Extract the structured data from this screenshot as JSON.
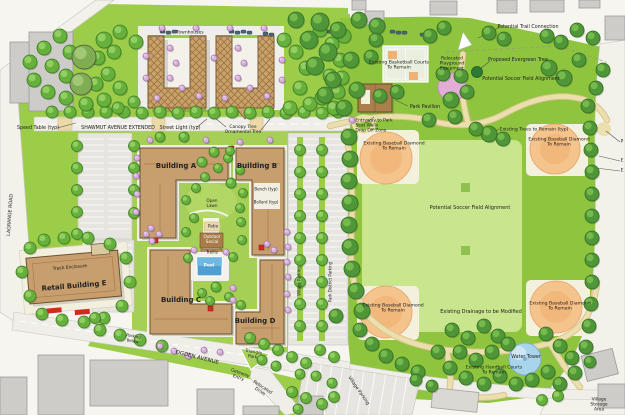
{
  "plan": {
    "type": "Illustrative Site Master Plan",
    "colors": {
      "lawn_green": "#9ccd49",
      "park_green": "#8ec43e",
      "soccer_field_green": "#c9e58e",
      "courtyard_green": "#a5d055",
      "building_tan": "#c79e6d",
      "building_outline": "#6e5130",
      "existing_gray_building": "#cdccc8",
      "road_gray": "#efeee8",
      "parking_gray": "#e6e5df",
      "path_tan": "#ecdfae",
      "baseball_orange": "#f5c48c",
      "pool_blue": "#4f9fd3",
      "water_tower_blue": "#a8d4ec",
      "playground_pink": "#e2aed6",
      "entry_marker_red": "#d02c1e"
    }
  },
  "labels": [
    {
      "id": "townhouses",
      "text": "Townhouses",
      "x": 190,
      "y": 33,
      "size": 4.5
    },
    {
      "id": "speed-table",
      "text": "Speed Table (typ)",
      "x": 38,
      "y": 129,
      "size": 4.8
    },
    {
      "id": "shawmut-avenue",
      "text": "SHAWMUT AVENUE EXTENDED",
      "x": 118,
      "y": 129,
      "size": 4.8
    },
    {
      "id": "street-light",
      "text": "Street Light (typ)",
      "x": 180,
      "y": 129,
      "size": 4.8
    },
    {
      "id": "canopy-tree",
      "text": "Canopy Tree\nOrnamental Tree",
      "x": 243,
      "y": 130,
      "size": 4.4
    },
    {
      "id": "lagrange-road",
      "text": "LAGRANGE ROAD",
      "x": 11,
      "y": 215,
      "size": 4.8,
      "rot": -86
    },
    {
      "id": "potential-trail",
      "text": "Potential Trail Connection",
      "x": 528,
      "y": 28,
      "size": 4.8
    },
    {
      "id": "evergreen-tree",
      "text": "Proposed Evergreen Tree",
      "x": 518,
      "y": 61,
      "size": 4.8
    },
    {
      "id": "soccer-alignment-ne",
      "text": "Potential Soccer Field Alignment",
      "x": 521,
      "y": 80,
      "size": 4.8
    },
    {
      "id": "basketball-courts",
      "text": "Existing Basketball Courts\nTo Remain",
      "x": 399,
      "y": 66,
      "size": 4.6
    },
    {
      "id": "playground",
      "text": "Relocated\nPlayground\nEquipment",
      "x": 452,
      "y": 64,
      "size": 4.4
    },
    {
      "id": "park-pavilion",
      "text": "Park Pavilion",
      "x": 425,
      "y": 108,
      "size": 4.8
    },
    {
      "id": "park-entry",
      "text": "Entryway to Park\nSeat Walls\nDrop Off Zone",
      "x": 374,
      "y": 126,
      "size": 4.4,
      "align": "left"
    },
    {
      "id": "trees-remain",
      "text": "Existing Trees to Remain (typ)",
      "x": 534,
      "y": 130,
      "size": 4.6
    },
    {
      "id": "diamond-nw",
      "text": "Existing Baseball Diamond\nTo Remain",
      "x": 394,
      "y": 147,
      "size": 4.6
    },
    {
      "id": "diamond-ne",
      "text": "Existing Baseball Diamond\nTo Remain",
      "x": 559,
      "y": 143,
      "size": 4.6
    },
    {
      "id": "soccer-alignment-center",
      "text": "Potential Soccer Field Alignment",
      "x": 470,
      "y": 209,
      "size": 5
    },
    {
      "id": "diamond-sw",
      "text": "Existing Baseball Diamond\nTo Remain",
      "x": 393,
      "y": 309,
      "size": 4.6
    },
    {
      "id": "diamond-se",
      "text": "Existing Baseball Diamond\nTo Remain",
      "x": 560,
      "y": 307,
      "size": 4.6
    },
    {
      "id": "drainage",
      "text": "Existing Drainage to be Modified",
      "x": 481,
      "y": 313,
      "size": 5
    },
    {
      "id": "water-tower",
      "text": "Water Tower",
      "x": 526,
      "y": 358,
      "size": 4.8
    },
    {
      "id": "handball-courts",
      "text": "Existing Handball Courts\nTo Remain",
      "x": 494,
      "y": 371,
      "size": 4.6
    },
    {
      "id": "village-parking-south",
      "text": "Village Parking",
      "x": 358,
      "y": 391,
      "size": 4.6,
      "rot": 55
    },
    {
      "id": "village-storage",
      "text": "Village Storage Area",
      "x": 599,
      "y": 405,
      "size": 4.4
    },
    {
      "id": "building-a",
      "text": "Building A",
      "x": 176,
      "y": 166,
      "size": 7,
      "bold": true
    },
    {
      "id": "building-b",
      "text": "Building B",
      "x": 257,
      "y": 166,
      "size": 7,
      "bold": true
    },
    {
      "id": "building-c",
      "text": "Building C",
      "x": 181,
      "y": 300,
      "size": 7,
      "bold": true
    },
    {
      "id": "building-d",
      "text": "Building D",
      "x": 255,
      "y": 321,
      "size": 7,
      "bold": true
    },
    {
      "id": "open-lawn",
      "text": "Open\nLawn",
      "x": 212,
      "y": 204,
      "size": 4.2
    },
    {
      "id": "bench",
      "text": "Bench (typ)",
      "x": 266,
      "y": 190,
      "size": 4
    },
    {
      "id": "bollard",
      "text": "Bollard (typ)",
      "x": 266,
      "y": 203,
      "size": 4
    },
    {
      "id": "patio",
      "text": "Patio",
      "x": 213,
      "y": 227,
      "size": 4.2
    },
    {
      "id": "outdoor-social",
      "text": "Outdoor\nSocial",
      "x": 212,
      "y": 240,
      "size": 4.2,
      "color": "#fff"
    },
    {
      "id": "trellis",
      "text": "Trellis",
      "x": 212,
      "y": 253,
      "size": 4.2
    },
    {
      "id": "pool",
      "text": "Pool",
      "x": 209,
      "y": 266,
      "size": 4.4,
      "color": "#fff",
      "bold": true
    },
    {
      "id": "parking-below",
      "text": "Parking\nBelow",
      "x": 133,
      "y": 339,
      "size": 4,
      "rot": 10
    },
    {
      "id": "ogden-avenue",
      "text": "OGDEN AVENUE",
      "x": 197,
      "y": 358,
      "size": 5.5,
      "rot": 14
    },
    {
      "id": "triangle-park",
      "text": "Triangle\nPark",
      "x": 253,
      "y": 355,
      "size": 4.4,
      "rot": 10
    },
    {
      "id": "gateway-entry",
      "text": "Gateway\nEntry",
      "x": 239,
      "y": 376,
      "size": 4.4,
      "rot": 20
    },
    {
      "id": "relocated-drive",
      "text": "Relocated\nDrive",
      "x": 261,
      "y": 390,
      "size": 4.4,
      "rot": 33
    },
    {
      "id": "village-parking-east",
      "text": "Village Parking",
      "x": 300,
      "y": 281,
      "size": 4,
      "rot": -90
    },
    {
      "id": "park-district-parking",
      "text": "Park District Parking",
      "x": 331,
      "y": 282,
      "size": 4,
      "rot": -90
    },
    {
      "id": "retail-building-e",
      "text": "Retail Building E",
      "x": 74,
      "y": 286,
      "size": 7,
      "bold": true,
      "rot": -5
    },
    {
      "id": "trash-enclosure",
      "text": "Trash Enclosure",
      "x": 70,
      "y": 268,
      "size": 4.4,
      "rot": -5
    },
    {
      "id": "edge-label-p",
      "text": "P",
      "x": 622,
      "y": 142,
      "size": 4.4
    },
    {
      "id": "edge-label-e1",
      "text": "E",
      "x": 622,
      "y": 161,
      "size": 4.4
    },
    {
      "id": "edge-label-e2",
      "text": "E",
      "x": 622,
      "y": 171,
      "size": 4.4
    }
  ]
}
